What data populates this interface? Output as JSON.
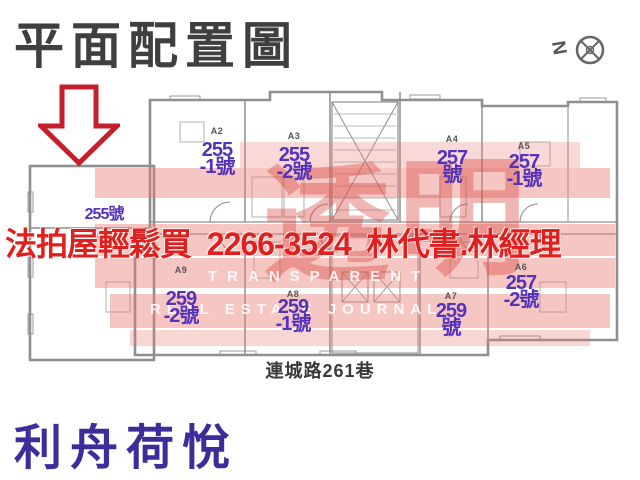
{
  "header": {
    "title": "平面配置圖"
  },
  "compass": {
    "letter": "N"
  },
  "ad": {
    "text": "法拍屋輕鬆買  2266-3524  林代書.林經理",
    "color": "#e01f1f"
  },
  "watermark": {
    "big_char_1": "透",
    "big_char_2": "明",
    "line1": "TRANSPARENT",
    "line2": "REAL ESTATE JOURNAL",
    "color": "#e97670"
  },
  "units": [
    {
      "code": "",
      "line1": "255號",
      "line2": ""
    },
    {
      "code": "A2",
      "line1": "255",
      "line2": "-1號"
    },
    {
      "code": "A3",
      "line1": "255",
      "line2": "-2號"
    },
    {
      "code": "A4",
      "line1": "257",
      "line2": "號"
    },
    {
      "code": "A5",
      "line1": "257",
      "line2": "-1號"
    },
    {
      "code": "A9",
      "line1": "259",
      "line2": "-2號"
    },
    {
      "code": "A8",
      "line1": "259",
      "line2": "-1號"
    },
    {
      "code": "A7",
      "line1": "259",
      "line2": "號"
    },
    {
      "code": "A6",
      "line1": "257",
      "line2": "-2號"
    }
  ],
  "street": {
    "label": "連城路261巷"
  },
  "footer": {
    "building_name": "利舟荷悅",
    "color": "#3c2d9b"
  },
  "colors": {
    "title": "#3f3f3f",
    "unit_number": "#5433bb",
    "unit_code": "#555555",
    "plan_line": "#8f8f8f",
    "arrow": "#c41f2b"
  }
}
